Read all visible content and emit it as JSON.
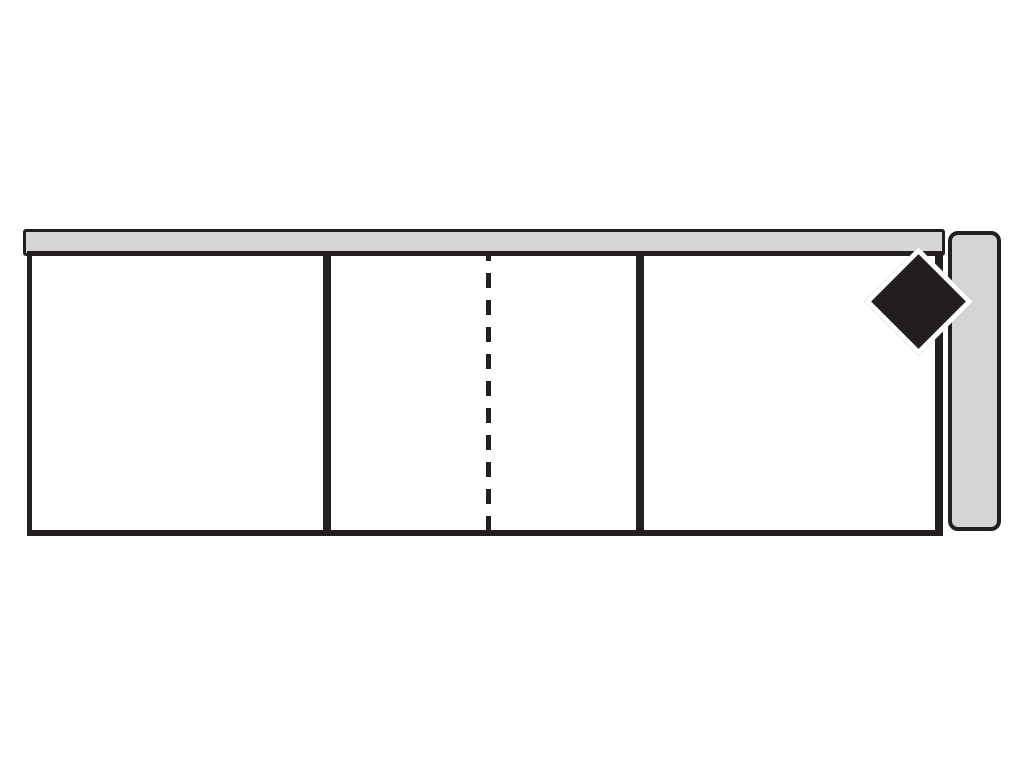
{
  "diagram": {
    "type": "furniture-plan-schematic",
    "visible_text": [],
    "colors": {
      "background": "#ffffff",
      "outline": "#231f20",
      "panel_fill": "#d5d5d5",
      "marker_fill": "#231f20",
      "marker_border": "#ffffff"
    },
    "elements": {
      "top_panel": "gray horizontal rail across the top of the cabinet",
      "cabinet_body": "wide rectangle outlined in black, divided into three compartments",
      "divider_left": "solid partition wall between left and middle compartments",
      "divider_right": "solid partition wall between middle and right compartments",
      "center_dashed_line": "vertical dashed line splitting the middle compartment",
      "side_panel_right": "rounded gray vertical panel attached at the right side",
      "corner_diamond_marker": "black diamond with white outline marking the top-right corner"
    }
  }
}
